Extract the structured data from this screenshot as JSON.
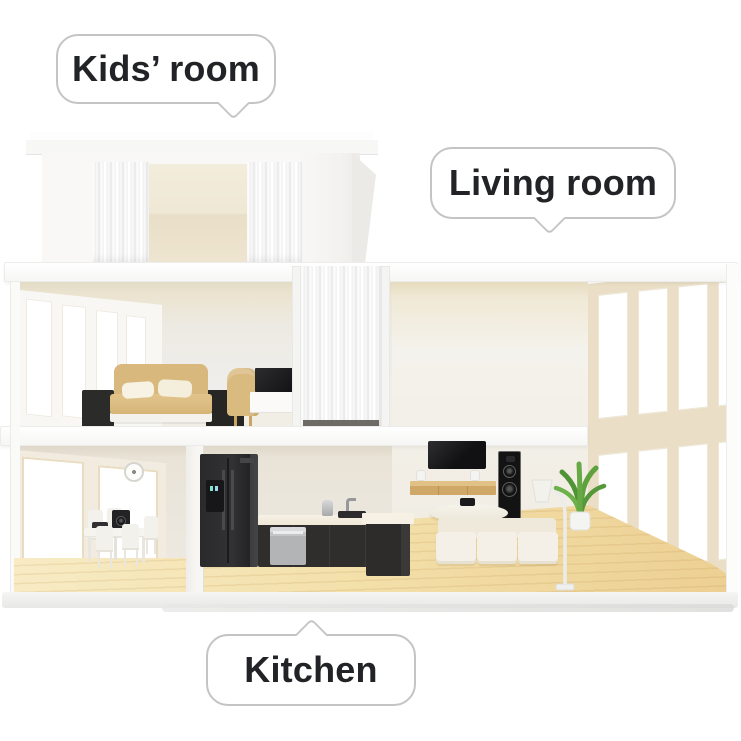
{
  "bubbles": [
    {
      "id": "kids-room",
      "label": "Kids’ room",
      "tail": "down"
    },
    {
      "id": "living-room",
      "label": "Living room",
      "tail": "down"
    },
    {
      "id": "kitchen",
      "label": "Kitchen",
      "tail": "up"
    }
  ],
  "colors": {
    "background": "#ffffff",
    "bubble_fill": "#ffffff",
    "bubble_border": "#c4c4c4",
    "bubble_text": "#222326",
    "wall_white": "#f6f5f2",
    "wall_warm_gray": "#eceae4",
    "ceiling_cream": "#efe7d2",
    "window_frame_beige": "#eadec3",
    "window_pane": "#ffffff",
    "wood_floor": "#f2dda8",
    "appliance_black": "#2b2b2d",
    "stainless_steel": "#b4b5b7",
    "bed_tan": "#d8b87c",
    "sofa_cream": "#f3efe6",
    "plant_green": "#5fa23d"
  }
}
